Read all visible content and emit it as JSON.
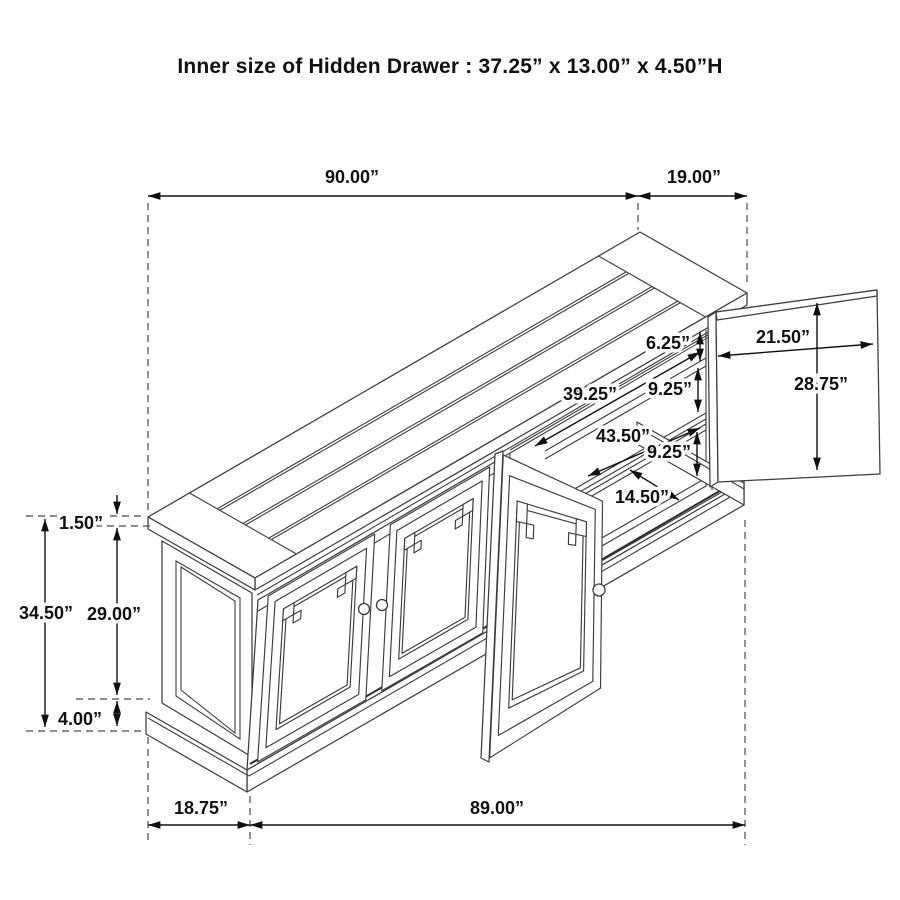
{
  "title": "Inner size of Hidden Drawer : 37.25” x 13.00” x 4.50”H",
  "diagram": {
    "subject": "sideboard-dimension-drawing",
    "unit": "inches",
    "dimension_labels": [
      {
        "id": "top-length",
        "label": "90.00”",
        "value": 90.0,
        "x": 352,
        "y": 177
      },
      {
        "id": "top-depth",
        "label": "19.00”",
        "value": 19.0,
        "x": 694,
        "y": 177
      },
      {
        "id": "shelf-spacing-top",
        "label": "6.25”",
        "value": 6.25,
        "x": 668,
        "y": 343
      },
      {
        "id": "shelf-spacing-mid",
        "label": "9.25”",
        "value": 9.25,
        "x": 670,
        "y": 389
      },
      {
        "id": "shelf-spacing-low",
        "label": "9.25”",
        "value": 9.25,
        "x": 669,
        "y": 452
      },
      {
        "id": "interior-width-upper",
        "label": "39.25”",
        "value": 39.25,
        "x": 590,
        "y": 394
      },
      {
        "id": "interior-width-lower",
        "label": "43.50”",
        "value": 43.5,
        "x": 623,
        "y": 436
      },
      {
        "id": "interior-depth",
        "label": "14.50”",
        "value": 14.5,
        "x": 642,
        "y": 497
      },
      {
        "id": "side-door-width",
        "label": "21.50”",
        "value": 21.5,
        "x": 783,
        "y": 337
      },
      {
        "id": "side-door-height",
        "label": "28.75”",
        "value": 28.75,
        "x": 821,
        "y": 384
      },
      {
        "id": "top-thickness",
        "label": "1.50”",
        "value": 1.5,
        "x": 81,
        "y": 523
      },
      {
        "id": "overall-height",
        "label": "34.50”",
        "value": 34.5,
        "x": 46,
        "y": 613
      },
      {
        "id": "door-height",
        "label": "29.00”",
        "value": 29.0,
        "x": 114,
        "y": 614
      },
      {
        "id": "base-height",
        "label": "4.00”",
        "value": 4.0,
        "x": 80,
        "y": 719
      },
      {
        "id": "end-depth",
        "label": "18.75”",
        "value": 18.75,
        "x": 201,
        "y": 808
      },
      {
        "id": "front-length",
        "label": "89.00”",
        "value": 89.0,
        "x": 497,
        "y": 808
      }
    ]
  }
}
